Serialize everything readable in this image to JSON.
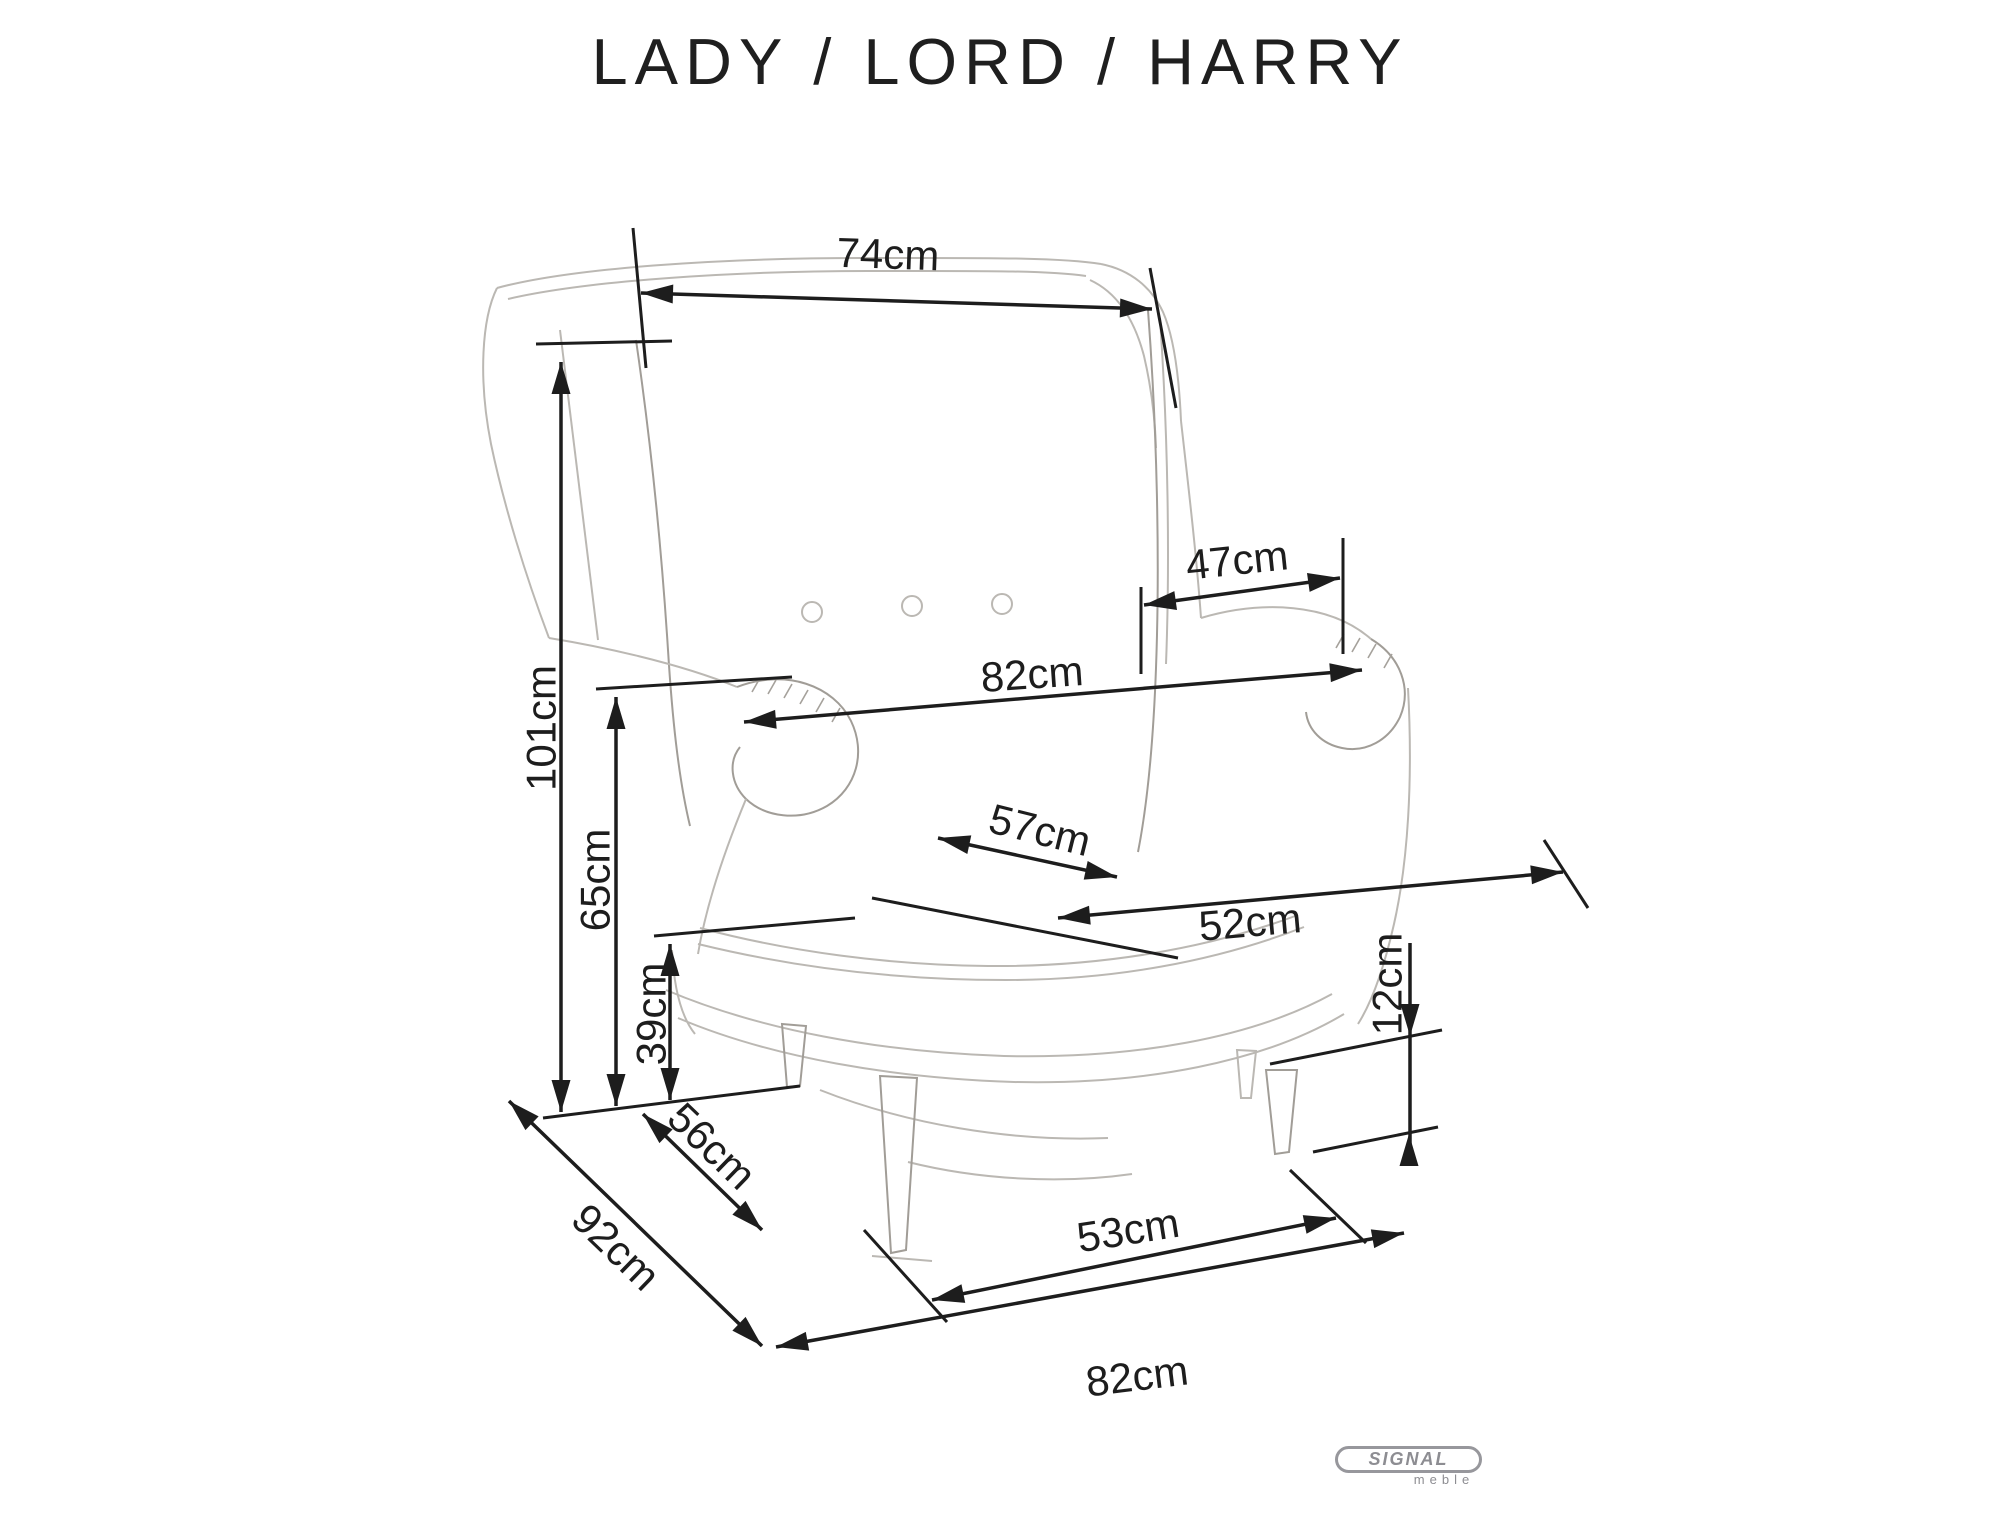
{
  "title": "LADY / LORD / HARRY",
  "brand": {
    "name": "SIGNAL",
    "tagline": "meble"
  },
  "unit": "cm",
  "colors": {
    "background": "#ffffff",
    "dimension": "#1d1d1d",
    "sketch": "#bbb8b3",
    "sketch_dark": "#a19d97",
    "logo_gray": "#8d8d92"
  },
  "dimensions": [
    {
      "id": "top-width-74",
      "label": "74cm",
      "lines": [
        [
          641,
          293,
          1152,
          309
        ]
      ],
      "arrows": [
        {
          "tip": [
            641,
            293
          ],
          "deg": 181.8
        },
        {
          "tip": [
            1152,
            309
          ],
          "deg": 1.8
        }
      ],
      "ext": [
        [
          633,
          228,
          646,
          368
        ],
        [
          1150,
          268,
          1176,
          408
        ]
      ],
      "label_pos": {
        "x": 888,
        "y": 254,
        "rot": 2
      }
    },
    {
      "id": "height-101",
      "label": "101cm",
      "lines": [
        [
          561,
          362,
          561,
          1112
        ]
      ],
      "arrows": [
        {
          "tip": [
            561,
            362
          ],
          "deg": -90
        },
        {
          "tip": [
            561,
            1112
          ],
          "deg": 90
        }
      ],
      "ext": [
        [
          536,
          344,
          672,
          341
        ]
      ],
      "label_pos": {
        "x": 541,
        "y": 728,
        "rot": -90
      }
    },
    {
      "id": "arm-height-65",
      "label": "65cm",
      "lines": [
        [
          616,
          697,
          616,
          1106
        ]
      ],
      "arrows": [
        {
          "tip": [
            616,
            697
          ],
          "deg": -90
        },
        {
          "tip": [
            616,
            1106
          ],
          "deg": 90
        }
      ],
      "ext": [
        [
          596,
          689,
          792,
          677
        ]
      ],
      "label_pos": {
        "x": 595,
        "y": 880,
        "rot": -90
      }
    },
    {
      "id": "seat-height-39",
      "label": "39cm",
      "lines": [
        [
          670,
          944,
          670,
          1100
        ]
      ],
      "arrows": [
        {
          "tip": [
            670,
            944
          ],
          "deg": -90
        },
        {
          "tip": [
            670,
            1100
          ],
          "deg": 90
        }
      ],
      "ext": [
        [
          654,
          936,
          855,
          918
        ],
        [
          543,
          1118,
          800,
          1086
        ]
      ],
      "label_pos": {
        "x": 651,
        "y": 1014,
        "rot": -90
      }
    },
    {
      "id": "seat-side-56",
      "label": "56cm",
      "lines": [
        [
          643,
          1114,
          762,
          1230
        ]
      ],
      "arrows": [
        {
          "tip": [
            643,
            1114
          ],
          "deg": 224
        },
        {
          "tip": [
            762,
            1230
          ],
          "deg": 44
        }
      ],
      "ext": [],
      "label_pos": {
        "x": 712,
        "y": 1146,
        "rot": 44
      }
    },
    {
      "id": "depth-92",
      "label": "92cm",
      "lines": [
        [
          509,
          1101,
          762,
          1346
        ]
      ],
      "arrows": [
        {
          "tip": [
            509,
            1101
          ],
          "deg": 224
        },
        {
          "tip": [
            762,
            1346
          ],
          "deg": 44
        }
      ],
      "ext": [],
      "label_pos": {
        "x": 616,
        "y": 1247,
        "rot": 44
      }
    },
    {
      "id": "base-width-82",
      "label": "82cm",
      "lines": [
        [
          776,
          1347,
          1404,
          1233
        ]
      ],
      "arrows": [
        {
          "tip": [
            776,
            1347
          ],
          "deg": 169.7
        },
        {
          "tip": [
            1404,
            1233
          ],
          "deg": -10.3
        }
      ],
      "ext": [],
      "label_pos": {
        "x": 1137,
        "y": 1376,
        "rot": -7
      }
    },
    {
      "id": "leg-span-53",
      "label": "53cm",
      "lines": [
        [
          932,
          1300,
          1336,
          1218
        ]
      ],
      "arrows": [
        {
          "tip": [
            932,
            1300
          ],
          "deg": 168.5
        },
        {
          "tip": [
            1336,
            1218
          ],
          "deg": -11.5
        }
      ],
      "ext": [
        [
          864,
          1230,
          947,
          1322
        ],
        [
          1290,
          1170,
          1366,
          1243
        ]
      ],
      "label_pos": {
        "x": 1128,
        "y": 1230,
        "rot": -9
      }
    },
    {
      "id": "leg-height-12",
      "label": "12cm",
      "lines": [
        [
          1410,
          943,
          1410,
          1160
        ]
      ],
      "arrows": [
        {
          "tip": [
            1410,
            1036
          ],
          "deg": 90
        },
        {
          "tip": [
            1409,
            1134
          ],
          "deg": -90
        }
      ],
      "ext": [
        [
          1270,
          1064,
          1442,
          1030
        ],
        [
          1313,
          1152,
          1438,
          1127
        ]
      ],
      "label_pos": {
        "x": 1387,
        "y": 984,
        "rot": -90
      }
    },
    {
      "id": "seat-width-47",
      "label": "47cm",
      "lines": [
        [
          1144,
          605,
          1340,
          578
        ]
      ],
      "arrows": [
        {
          "tip": [
            1144,
            605
          ],
          "deg": 172
        },
        {
          "tip": [
            1340,
            578
          ],
          "deg": -8
        }
      ],
      "ext": [
        [
          1141,
          587,
          1141,
          674
        ],
        [
          1343,
          538,
          1343,
          654
        ]
      ],
      "label_pos": {
        "x": 1237,
        "y": 560,
        "rot": -6
      }
    },
    {
      "id": "arm-width-82",
      "label": "82cm",
      "lines": [
        [
          744,
          722,
          1362,
          670
        ]
      ],
      "arrows": [
        {
          "tip": [
            744,
            722
          ],
          "deg": 175.2
        },
        {
          "tip": [
            1362,
            670
          ],
          "deg": -4.8
        }
      ],
      "ext": [],
      "label_pos": {
        "x": 1032,
        "y": 674,
        "rot": -4
      }
    },
    {
      "id": "seat-depth-57",
      "label": "57cm",
      "lines": [
        [
          938,
          838,
          1117,
          877
        ]
      ],
      "arrows": [
        {
          "tip": [
            938,
            838
          ],
          "deg": 192
        },
        {
          "tip": [
            1117,
            877
          ],
          "deg": 12
        }
      ],
      "ext": [
        [
          872,
          898,
          1178,
          958
        ]
      ],
      "label_pos": {
        "x": 1040,
        "y": 830,
        "rot": 14
      }
    },
    {
      "id": "seat-front-52",
      "label": "52cm",
      "lines": [
        [
          1058,
          918,
          1563,
          872
        ]
      ],
      "arrows": [
        {
          "tip": [
            1058,
            918
          ],
          "deg": 174.9
        },
        {
          "tip": [
            1563,
            872
          ],
          "deg": -5.1
        }
      ],
      "ext": [
        [
          1544,
          840,
          1588,
          908
        ]
      ],
      "label_pos": {
        "x": 1250,
        "y": 922,
        "rot": -5
      }
    }
  ]
}
